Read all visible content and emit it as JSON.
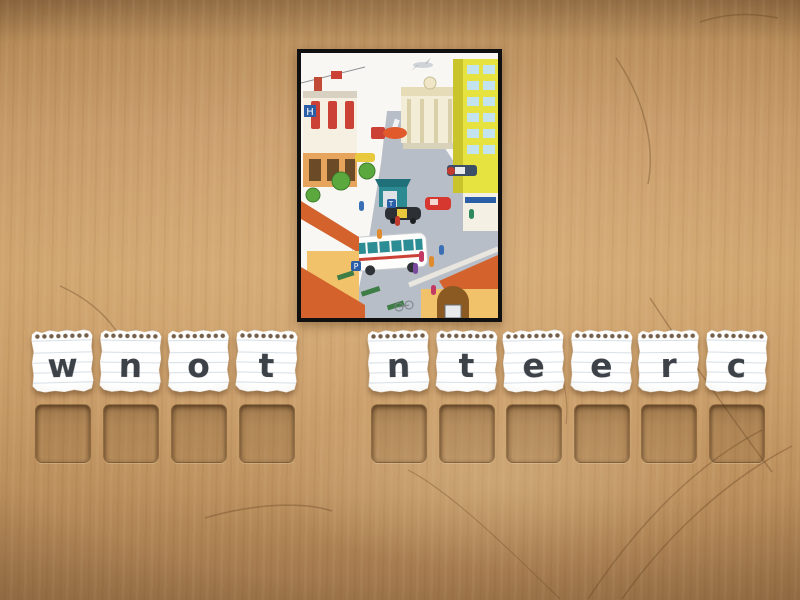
{
  "image": {
    "alt": "Busy cartoon town centre street scene with buildings, bus, taxi, cars and people",
    "parking_sign_label": "P",
    "taxi_sign_label": "T",
    "hotel_sign_label": "H"
  },
  "words": [
    {
      "letters": [
        "w",
        "n",
        "o",
        "t"
      ]
    },
    {
      "letters": [
        "n",
        "t",
        "e",
        "e",
        "r",
        "c"
      ]
    }
  ],
  "slots": {
    "word1": 4,
    "word2": 6
  },
  "colors": {
    "wood": "#c89b66",
    "wood_shadow": "#8d6840",
    "paper": "#f5f4f0",
    "ruled_line": "#8fa9bd",
    "letter": "#3d4248",
    "slot_fill": "rgba(88,56,26,0.30)",
    "frame": "#101010",
    "roof_terracotta": "#d3622c",
    "building_yellow": "#e6e23f",
    "kiosk_teal": "#2c8b92",
    "road_gray": "#b8bec7"
  }
}
